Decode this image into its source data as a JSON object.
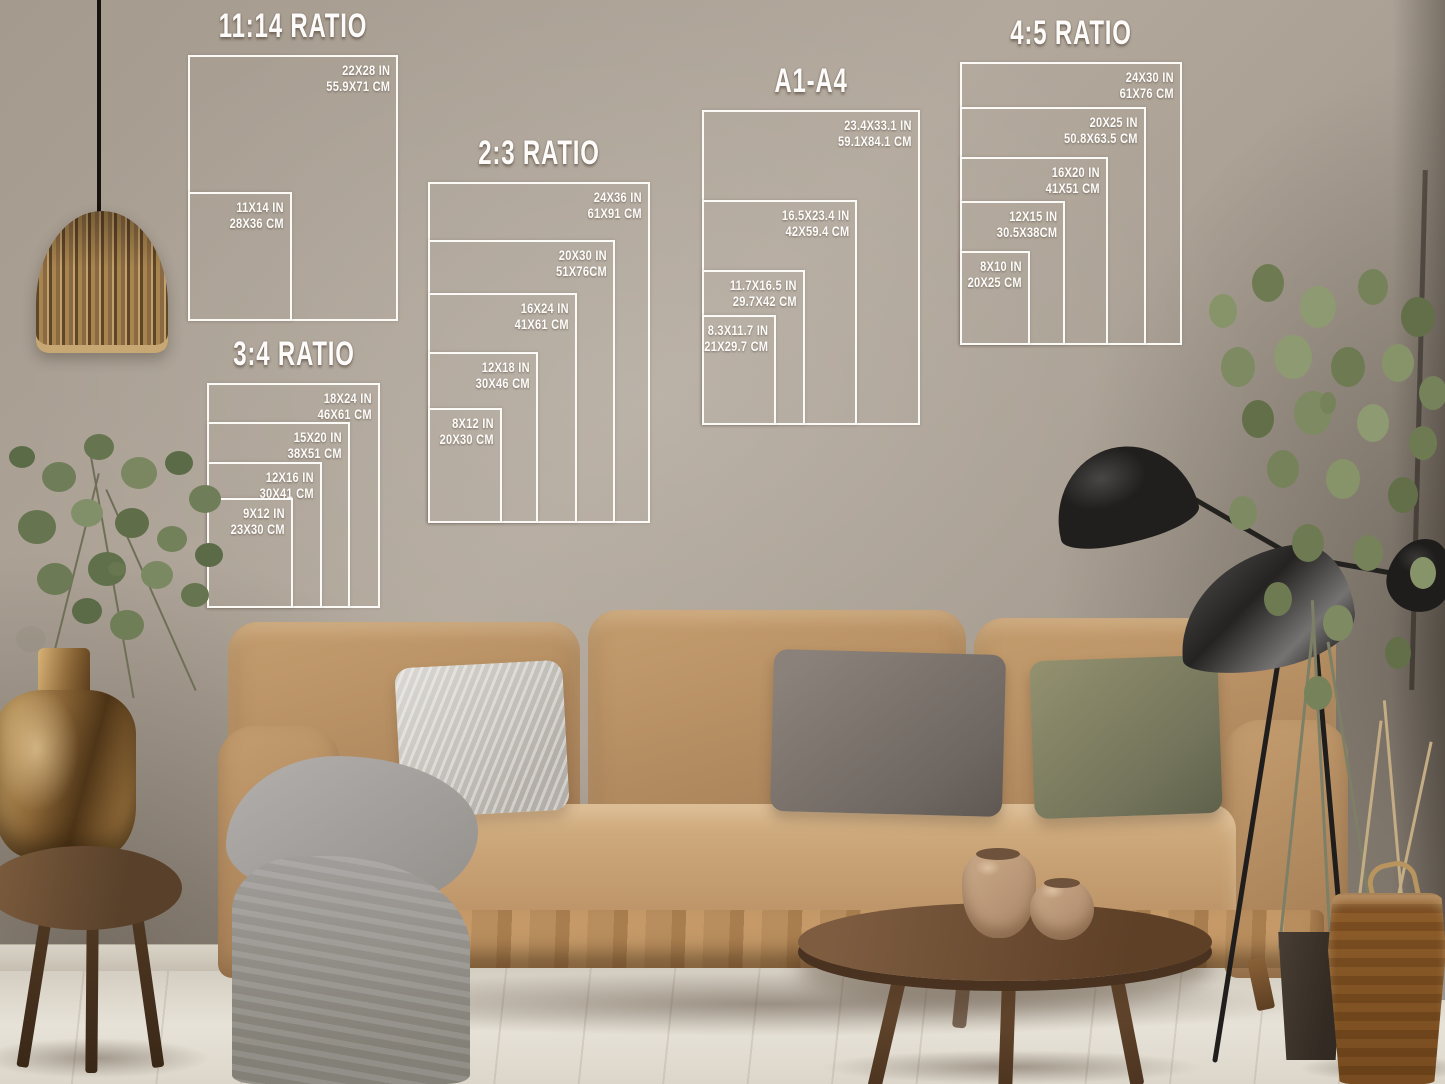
{
  "overlay": {
    "line_color": "#ffffff",
    "text_color": "#ffffff",
    "groups": [
      {
        "title": "11:14 RATIO",
        "sizes": [
          {
            "in": "22X28 IN",
            "cm": "55.9X71 CM"
          },
          {
            "in": "11X14 IN",
            "cm": "28X36 CM"
          }
        ]
      },
      {
        "title": "3:4 RATIO",
        "sizes": [
          {
            "in": "18X24 IN",
            "cm": "46X61 CM"
          },
          {
            "in": "15X20 IN",
            "cm": "38X51 CM"
          },
          {
            "in": "12X16 IN",
            "cm": "30X41 CM"
          },
          {
            "in": "9X12 IN",
            "cm": "23X30 CM"
          }
        ]
      },
      {
        "title": "2:3 RATIO",
        "sizes": [
          {
            "in": "24X36 IN",
            "cm": "61X91 CM"
          },
          {
            "in": "20X30 IN",
            "cm": "51X76CM"
          },
          {
            "in": "16X24 IN",
            "cm": "41X61 CM"
          },
          {
            "in": "12X18 IN",
            "cm": "30X46 CM"
          },
          {
            "in": "8X12 IN",
            "cm": "20X30 CM"
          }
        ]
      },
      {
        "title": "A1-A4",
        "sizes": [
          {
            "in": "23.4X33.1 IN",
            "cm": "59.1X84.1 CM"
          },
          {
            "in": "16.5X23.4 IN",
            "cm": "42X59.4 CM"
          },
          {
            "in": "11.7X16.5 IN",
            "cm": "29.7X42 CM"
          },
          {
            "in": "8.3X11.7 IN",
            "cm": "21X29.7 CM"
          }
        ]
      },
      {
        "title": "4:5 RATIO",
        "sizes": [
          {
            "in": "24X30 IN",
            "cm": "61X76 CM"
          },
          {
            "in": "20X25 IN",
            "cm": "50.8X63.5 CM"
          },
          {
            "in": "16X20 IN",
            "cm": "41X51 CM"
          },
          {
            "in": "12X15 IN",
            "cm": "30.5X38CM"
          },
          {
            "in": "8X10 IN",
            "cm": "20X25 CM"
          }
        ]
      }
    ]
  },
  "scene": {
    "colors": {
      "wall": "#a79d91",
      "floor": "#ddd7ca",
      "couch": "#b98e61",
      "pillow_gray": "#cfccc7",
      "pillow_dark": "#7d746d",
      "pillow_olive": "#8b8a6c",
      "blanket": "#a5a19e",
      "wood": "#6f4e2d",
      "brass_vase": "#b08748",
      "lamp_black": "#242322",
      "plant_green": "#6f7d58",
      "basket": "#b8945f",
      "overlay_line": "#ffffff"
    }
  }
}
